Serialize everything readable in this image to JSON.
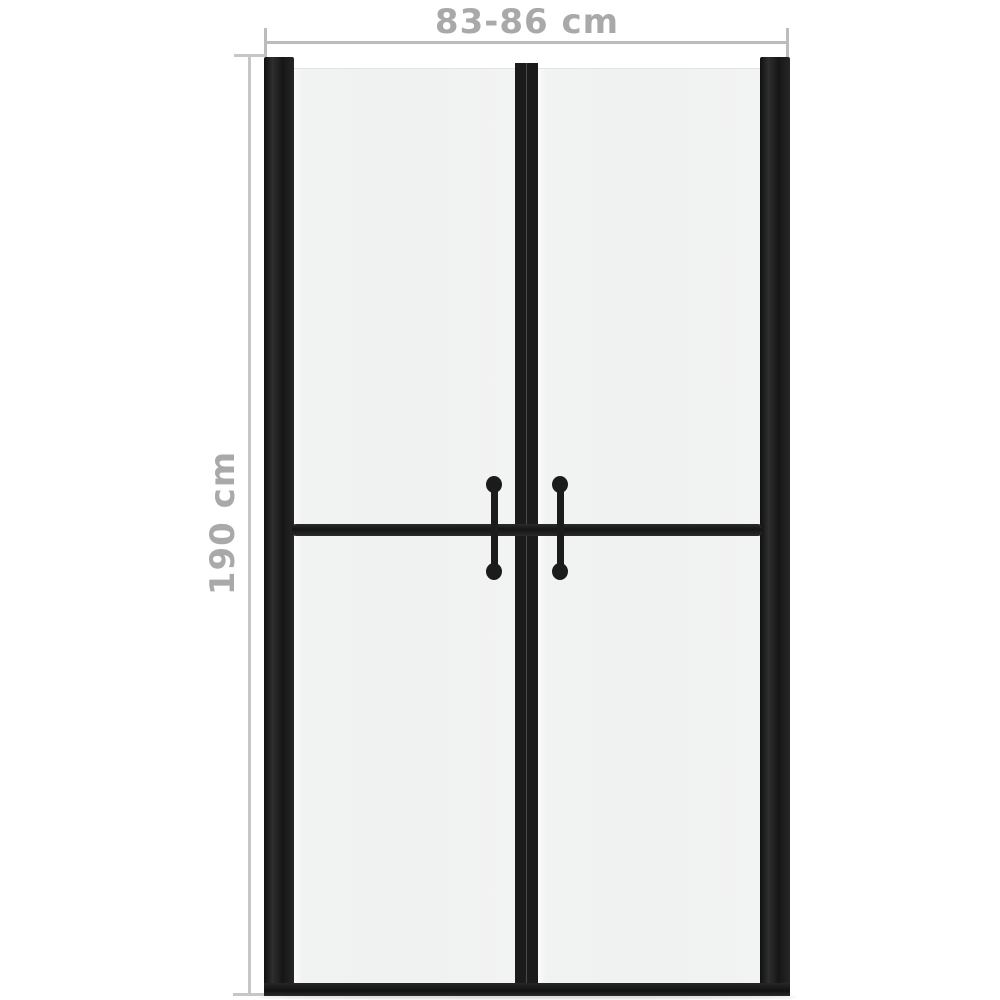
{
  "diagram": {
    "kind": "product-dimension-diagram",
    "product": "double-wing shower door with frosted glass and black frame",
    "dimensions": {
      "width_label": "83-86 cm",
      "height_label": "190 cm"
    },
    "colors": {
      "frame": "#1b1b1b",
      "glass": "#f1f2f2",
      "dimension_line": "#bcbcbc",
      "dimension_text": "#a9a9a9",
      "background": "#ffffff"
    }
  }
}
